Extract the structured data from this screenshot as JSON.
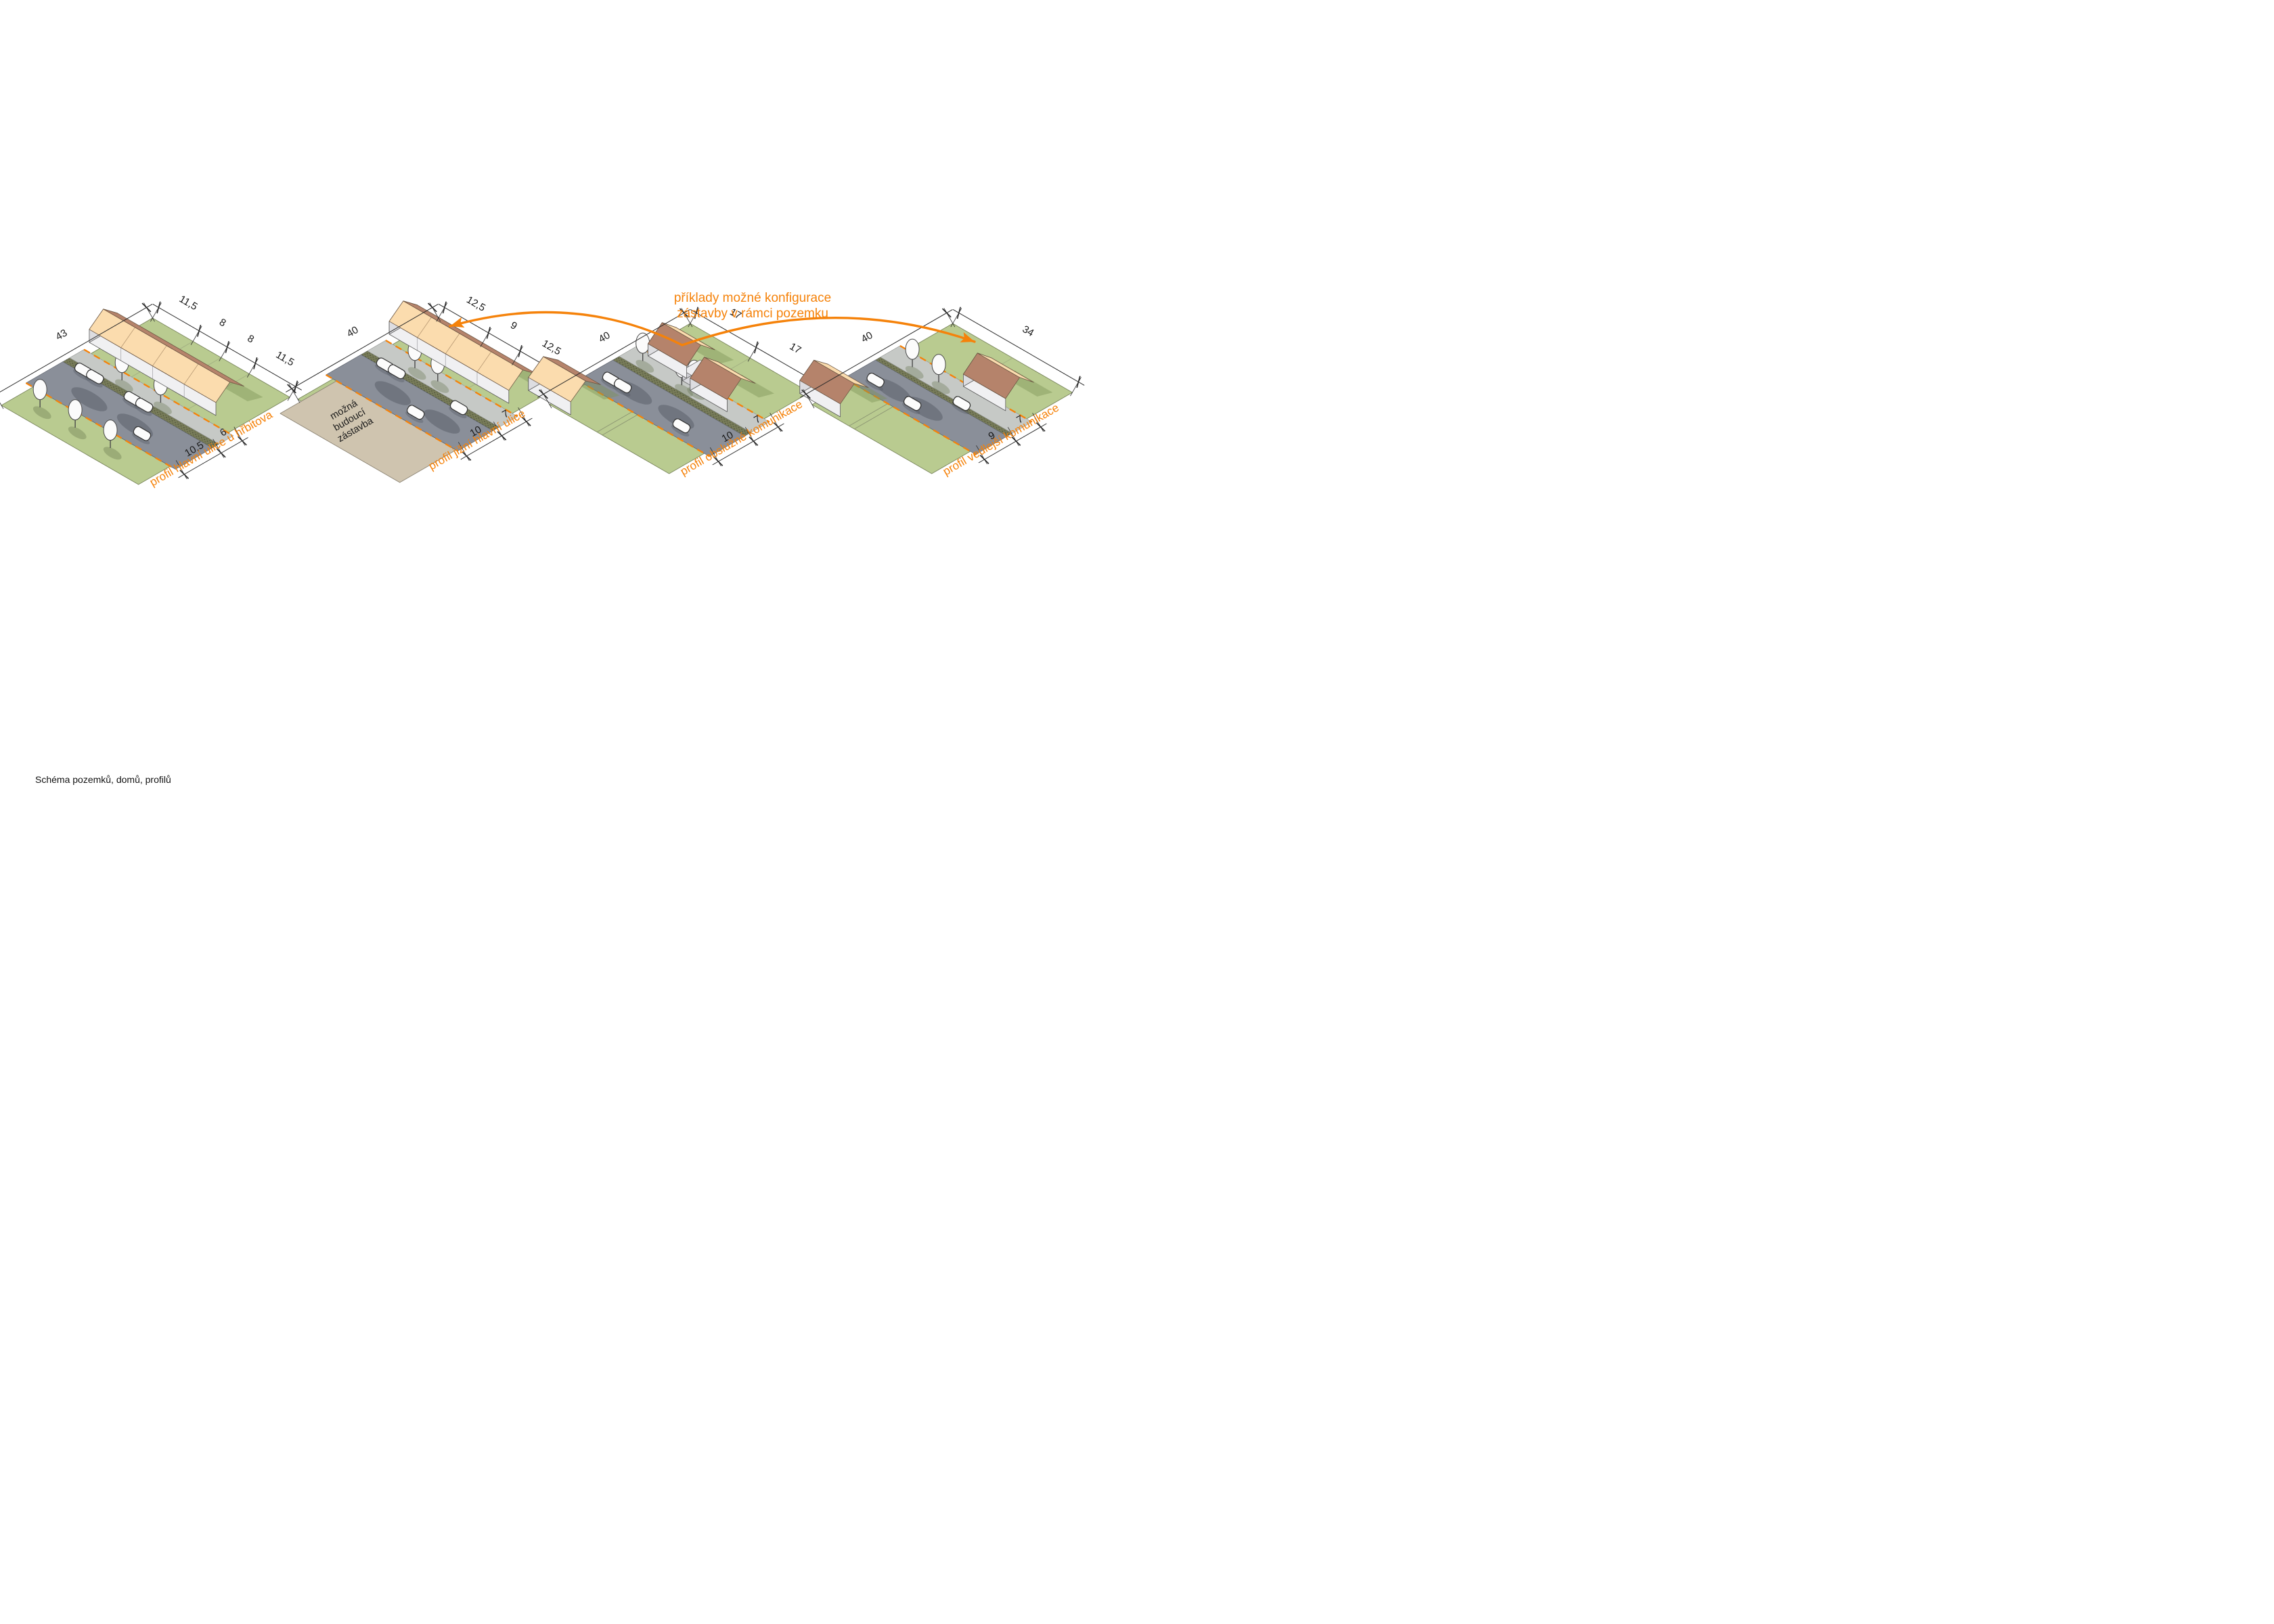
{
  "caption": "Schéma pozemků, domů, profilů",
  "annotation": {
    "line1": "příklady možné konfigurace",
    "line2": "zástavby v rámci pozemku"
  },
  "colors": {
    "accent": "#F5820A",
    "plot_green": "#B9CB90",
    "road_gray": "#8A8F99",
    "sidewalk_gray": "#C6C9C6",
    "roof_peach": "#FBDCAE",
    "roof_brown": "#B5836B",
    "future_parcel_tan": "#CFC4AF"
  },
  "scenes": [
    {
      "id": "scene-1",
      "profile_label": "profil hlavní ulice u hřbitova",
      "dim_depth": "43",
      "dims_frontage": [
        "11,5",
        "8",
        "8",
        "11,5"
      ],
      "dims_street": [
        "10,5",
        "6"
      ]
    },
    {
      "id": "scene-2",
      "profile_label": "profil jižní hlavní ulice",
      "dim_depth": "40",
      "dims_frontage": [
        "12,5",
        "9",
        "12,5"
      ],
      "dims_street": [
        "10",
        "7"
      ],
      "parcel_note": [
        "možná",
        "budoucí",
        "zástavba"
      ]
    },
    {
      "id": "scene-3",
      "profile_label": "profil obslužné komunikace",
      "dim_depth": "40",
      "dims_frontage": [
        "17",
        "17"
      ],
      "dims_street": [
        "10",
        "7"
      ]
    },
    {
      "id": "scene-4",
      "profile_label": "profil vedlejší komunikace",
      "dim_depth": "40",
      "dims_frontage": [
        "34"
      ],
      "dims_street": [
        "9",
        "7"
      ]
    }
  ]
}
